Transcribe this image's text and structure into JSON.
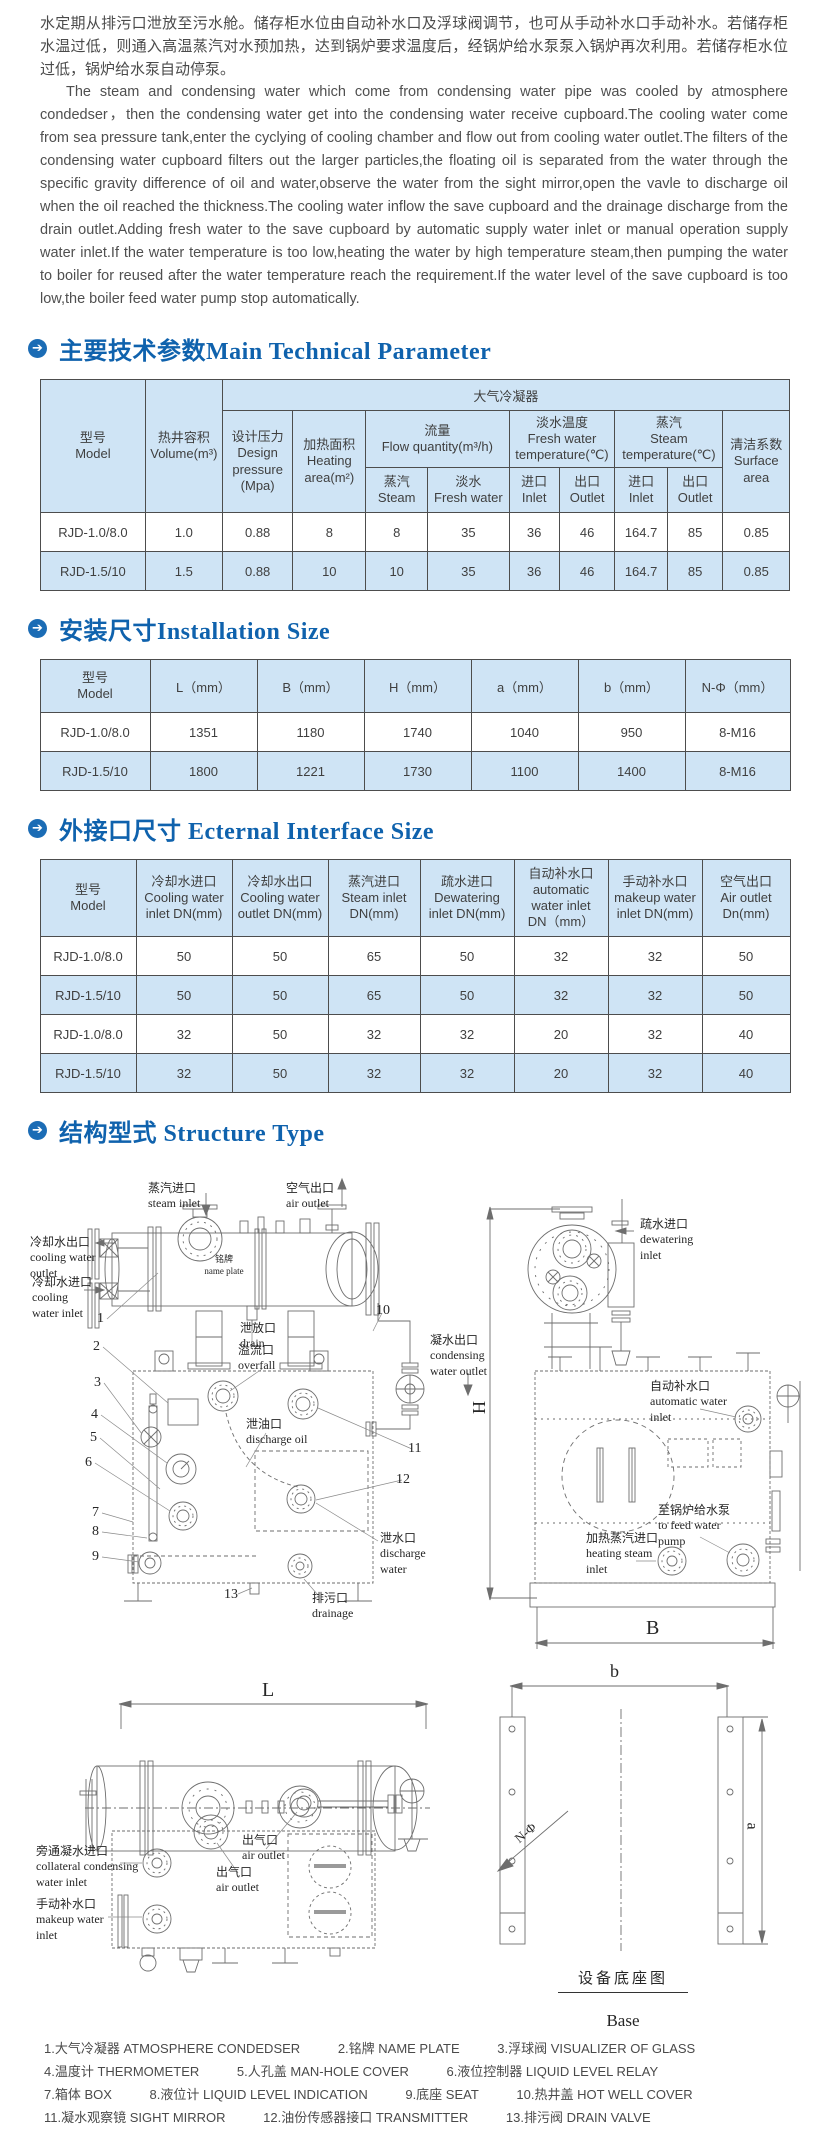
{
  "intro": {
    "cn": "水定期从排污口泄放至污水舱。储存柜水位由自动补水口及浮球阀调节，也可从手动补水口手动补水。若储存柜水温过低，则通入高温蒸汽对水预加热，达到锅炉要求温度后，经锅炉给水泵泵入锅炉再次利用。若储存柜水位过低，锅炉给水泵自动停泵。",
    "en": "The steam and condensing water which come from condensing water pipe was cooled by atmosphere condedser，then the condensing water get into the condensing water receive cupboard.The cooling water come from sea pressure tank,enter the cyclying of cooling chamber and flow out from cooling water outlet.The filters of the condensing water cupboard filters out the larger particles,the floating oil is separated from the water through the specific gravity difference of oil and water,observe the water from the sight mirror,open the vavle to discharge oil when the oil reached the thickness.The cooling water inflow the save cupboard and the drainage discharge from the drain outlet.Adding fresh water to the save cupboard by automatic supply water inlet or manual operation supply water inlet.If the water temperature is too low,heating the water by high temperature steam,then pumping the water to boiler for reused after the water temperature reach the requirement.If the water level of the save cupboard is too low,the boiler feed water pump stop automatically."
  },
  "headings": {
    "arrow": "➔",
    "tech": "主要技术参数Main Technical Parameter",
    "install": "安装尺寸Installation Size",
    "interface": "外接口尺寸 Ecternal Interface Size",
    "structure": "结构型式 Structure Type"
  },
  "tech_table": {
    "condenser_group": "大气冷凝器",
    "model": "型号\nModel",
    "volume": "热井容积\nVolume(m³)",
    "design_pressure": "设计压力\nDesign\npressure\n(Mpa)",
    "heating_area": "加热面积\nHeating\narea(m²)",
    "flow": "流量\nFlow quantity(m³/h)",
    "flow_steam": "蒸汽\nSteam",
    "flow_fresh": "淡水\nFresh water",
    "fresh_temp": "淡水温度\nFresh water\ntemperature(℃)",
    "steam_temp": "蒸汽\nSteam\ntemperature(℃)",
    "inlet": "进口\nInlet",
    "outlet": "出口\nOutlet",
    "surface": "清洁系数\nSurface\narea",
    "rows": [
      [
        "RJD-1.0/8.0",
        "1.0",
        "0.88",
        "8",
        "8",
        "35",
        "36",
        "46",
        "164.7",
        "85",
        "0.85"
      ],
      [
        "RJD-1.5/10",
        "1.5",
        "0.88",
        "10",
        "10",
        "35",
        "36",
        "46",
        "164.7",
        "85",
        "0.85"
      ]
    ]
  },
  "install_table": {
    "headers": [
      "型号\nModel",
      "L（mm）",
      "B（mm）",
      "H（mm）",
      "a（mm）",
      "b（mm）",
      "N-Φ（mm）"
    ],
    "rows": [
      [
        "RJD-1.0/8.0",
        "1351",
        "1180",
        "1740",
        "1040",
        "950",
        "8-M16"
      ],
      [
        "RJD-1.5/10",
        "1800",
        "1221",
        "1730",
        "1100",
        "1400",
        "8-M16"
      ]
    ]
  },
  "interface_table": {
    "headers": [
      "型号\nModel",
      "冷却水进口\nCooling water\ninlet DN(mm)",
      "冷却水出口\nCooling water\noutlet DN(mm)",
      "蒸汽进口\nSteam inlet\nDN(mm)",
      "疏水进口\nDewatering\ninlet DN(mm)",
      "自动补水口\nautomatic\nwater inlet\nDN（mm）",
      "手动补水口\nmakeup water\ninlet DN(mm)",
      "空气出口\nAir outlet\nDn(mm)"
    ],
    "rows": [
      [
        "RJD-1.0/8.0",
        "50",
        "50",
        "65",
        "50",
        "32",
        "32",
        "50"
      ],
      [
        "RJD-1.5/10",
        "50",
        "50",
        "65",
        "50",
        "32",
        "32",
        "50"
      ],
      [
        "RJD-1.0/8.0",
        "32",
        "50",
        "32",
        "32",
        "20",
        "32",
        "40"
      ],
      [
        "RJD-1.5/10",
        "32",
        "50",
        "32",
        "32",
        "20",
        "32",
        "40"
      ]
    ]
  },
  "diagram": {
    "labels": {
      "steam_inlet": "蒸汽进口\nsteam inlet",
      "air_outlet_top": "空气出口\nair outlet",
      "cooling_water_outlet": "冷却水出口\ncooling water\noutlet",
      "cooling_water_inlet": "冷却水进口\ncooling\nwater inlet",
      "name_plate": "铭牌\nname plate",
      "drain": "泄放口\ndrain",
      "overfall": "溢流口\noverfall",
      "discharge_oil": "泄油口\ndischarge oil",
      "discharge_water": "泄水口\ndischarge\nwater",
      "drainage": "排污口\ndrainage",
      "condensing_water_outlet": "凝水出口\ncondensing\nwater outlet",
      "dewatering_inlet": "疏水进口\ndewatering\ninlet",
      "automatic_water_inlet": "自动补水口\nautomatic water\ninlet",
      "to_feed_water_pump": "至锅炉给水泵\nto feed water\npump",
      "heating_steam_inlet": "加热蒸汽进口\nheating steam\ninlet",
      "collateral_condensing_water_inlet": "旁通凝水进口\ncollateral condensing\nwater inlet",
      "makeup_water_inlet": "手动补水口\nmakeup water\ninlet",
      "air_outlet_c1": "出气口\nair outlet",
      "air_outlet_c2": "出气口\nair outlet",
      "base_caption_cn": "设备底座图",
      "base_caption_en": "Base"
    },
    "dims": {
      "H": "H",
      "B": "B",
      "L": "L",
      "b": "b",
      "a": "a",
      "n_phi": "N-Φ"
    },
    "numbers": [
      "1",
      "2",
      "3",
      "4",
      "5",
      "6",
      "7",
      "8",
      "9",
      "10",
      "11",
      "12",
      "13"
    ]
  },
  "legend": {
    "lines": [
      [
        "1.大气冷凝器 ATMOSPHERE CONDEDSER",
        "2.铭牌 NAME PLATE",
        "3.浮球阀 VISUALIZER OF GLASS"
      ],
      [
        "4.温度计 THERMOMETER",
        "5.人孔盖 MAN-HOLE COVER",
        "6.液位控制器 LIQUID LEVEL RELAY"
      ],
      [
        "7.箱体 BOX",
        "8.液位计 LIQUID LEVEL INDICATION",
        "9.底座 SEAT",
        "10.热井盖 HOT WELL COVER"
      ],
      [
        "11.凝水观察镜 SIGHT MIRROR",
        "12.油份传感器接口 TRANSMITTER",
        "13.排污阀 DRAIN VALVE"
      ]
    ]
  }
}
